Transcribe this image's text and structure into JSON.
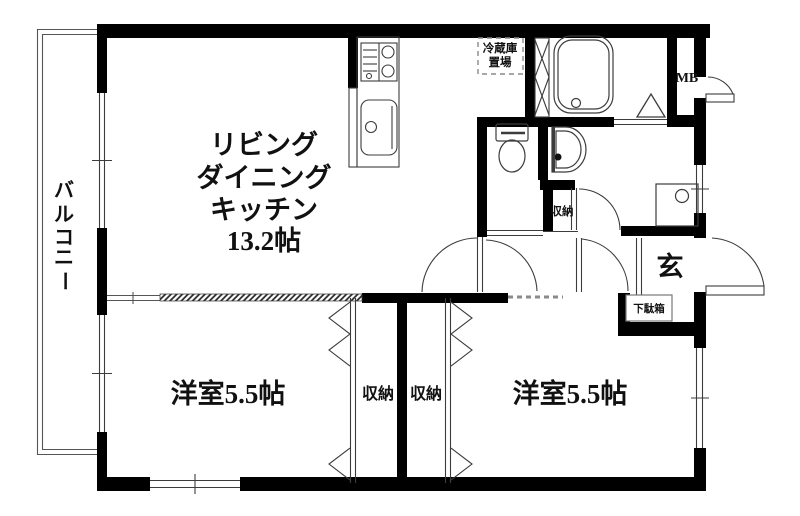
{
  "colors": {
    "wall": "#000000",
    "thin_line": "#3c3c3c",
    "gray_line": "#777777",
    "dash": "#8a8a8a",
    "text": "#111111"
  },
  "rooms": {
    "ldk": {
      "lines": [
        "リビング",
        "ダイニング",
        "キッチン",
        "13.2帖"
      ]
    },
    "bedroom_left": {
      "label": "洋室5.5帖"
    },
    "bedroom_right": {
      "label": "洋室5.5帖"
    },
    "balcony": {
      "label": "バルコニー",
      "chars": [
        "バ",
        "ル",
        "コ",
        "ニ",
        "ー"
      ]
    },
    "entrance": {
      "label": "玄"
    },
    "closet_left": {
      "label": "収納"
    },
    "closet_right": {
      "label": "収納"
    },
    "hall_closet": {
      "label": "収納"
    },
    "shoe_cabinet": {
      "label": "下駄箱"
    },
    "meter_box": {
      "label": "MB"
    },
    "refrigerator_space": {
      "lines": [
        "冷蔵庫",
        "置場"
      ]
    }
  },
  "fixtures": [
    "stove-icon",
    "kitchen-sink-icon",
    "bathtub-icon",
    "toilet-icon",
    "washbasin-icon",
    "washing-machine-pan-icon",
    "folding-door-icon",
    "pipe-shaft-icon",
    "door-swing-arc",
    "accordion-door-zigzag",
    "sliding-window",
    "entrance-step"
  ]
}
